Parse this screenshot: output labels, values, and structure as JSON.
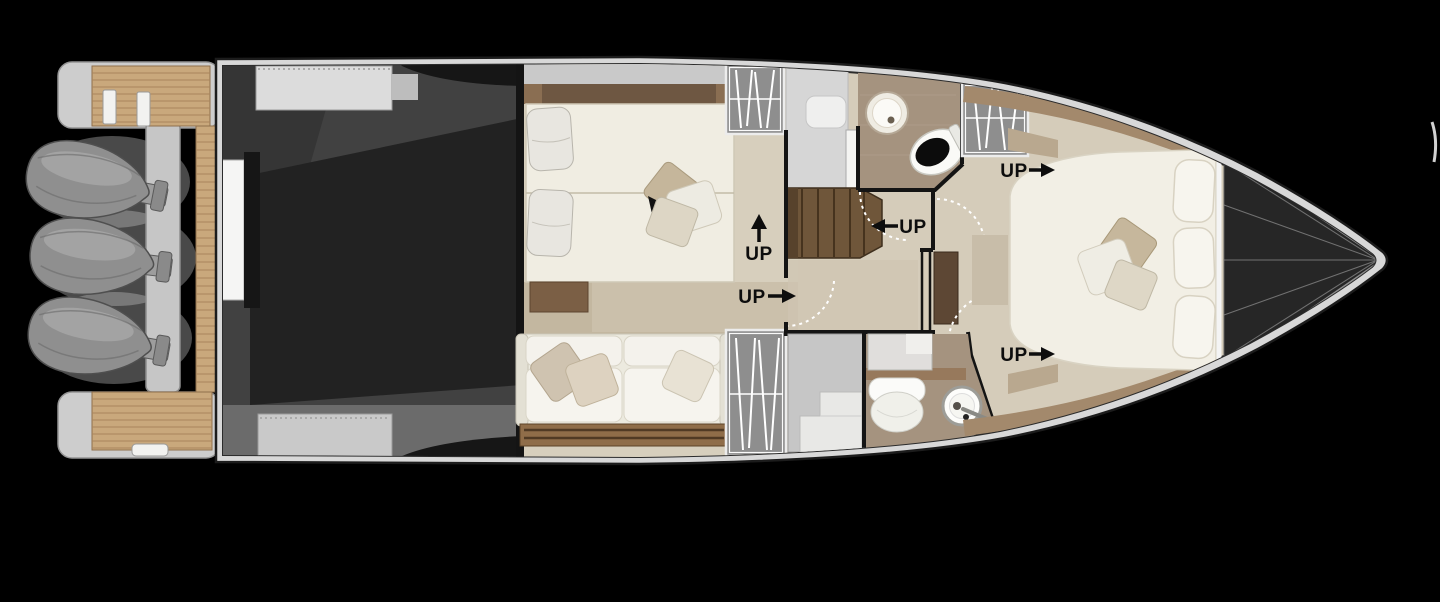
{
  "canvas": {
    "width": 1440,
    "height": 602,
    "background": "#000000"
  },
  "plan": {
    "labels": {
      "up_mid_stairs": {
        "text": "UP",
        "arrow_direction": "up"
      },
      "up_mid_door": {
        "text": "UP",
        "arrow_direction": "right"
      },
      "up_corridor": {
        "text": "UP",
        "arrow_direction": "left"
      },
      "up_fwd_top": {
        "text": "UP",
        "arrow_direction": "right"
      },
      "up_fwd_bottom": {
        "text": "UP",
        "arrow_direction": "right"
      }
    },
    "engine_count": 3,
    "colors": {
      "background": "#000000",
      "hull_band": "#d8d8d8",
      "hull_outline": "#1c1c1c",
      "teak": "#c9a87c",
      "teak_line": "#a9855c",
      "engine_gray": "#8f8f8f",
      "garage_dark": "#3f3f3f",
      "garage_black": "#222222",
      "floor_beige": "#d5ccba",
      "floor_taupe": "#a5937f",
      "walkway_tan": "#c3b7a0",
      "wood_dark": "#6e5742",
      "stair_wood": "#6f563a",
      "bed_linen": "#f0ede2",
      "sofa_white": "#f4f2ec",
      "locker_gray": "#8e8e8e",
      "bow_dark": "#262626",
      "wall_black": "#141414",
      "label_text": "#0d0d0d",
      "door_arc": "#ffffff"
    }
  }
}
